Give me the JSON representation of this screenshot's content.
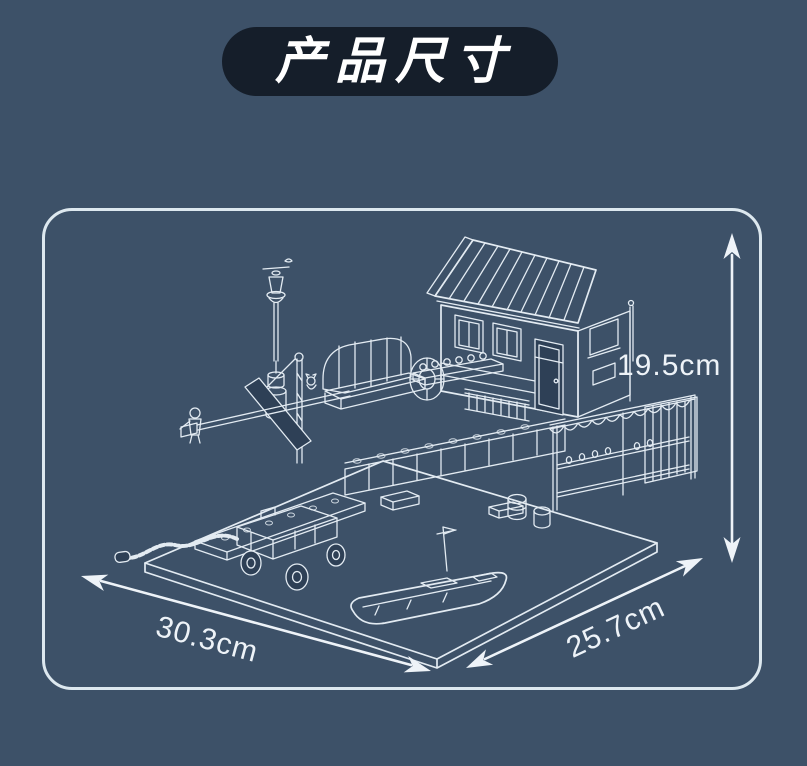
{
  "header": {
    "title": "产品尺寸"
  },
  "diagram": {
    "height_label": "19.5cm",
    "width_label": "30.3cm",
    "depth_label": "25.7cm",
    "subject": "isometric-brick-building-harbor-set-line-art",
    "icons": {
      "height_arrow": "double-arrow-vertical",
      "width_arrow": "double-arrow-diagonal-left",
      "depth_arrow": "double-arrow-diagonal-right"
    }
  },
  "colors": {
    "background": "#3d5168",
    "badge_bg": "#151e2a",
    "badge_text": "#ffffff",
    "panel_border": "#dde8ef",
    "line_art": "#e3ebf2",
    "dark_fill": "#2e4056",
    "label_text": "#eef3f8"
  }
}
